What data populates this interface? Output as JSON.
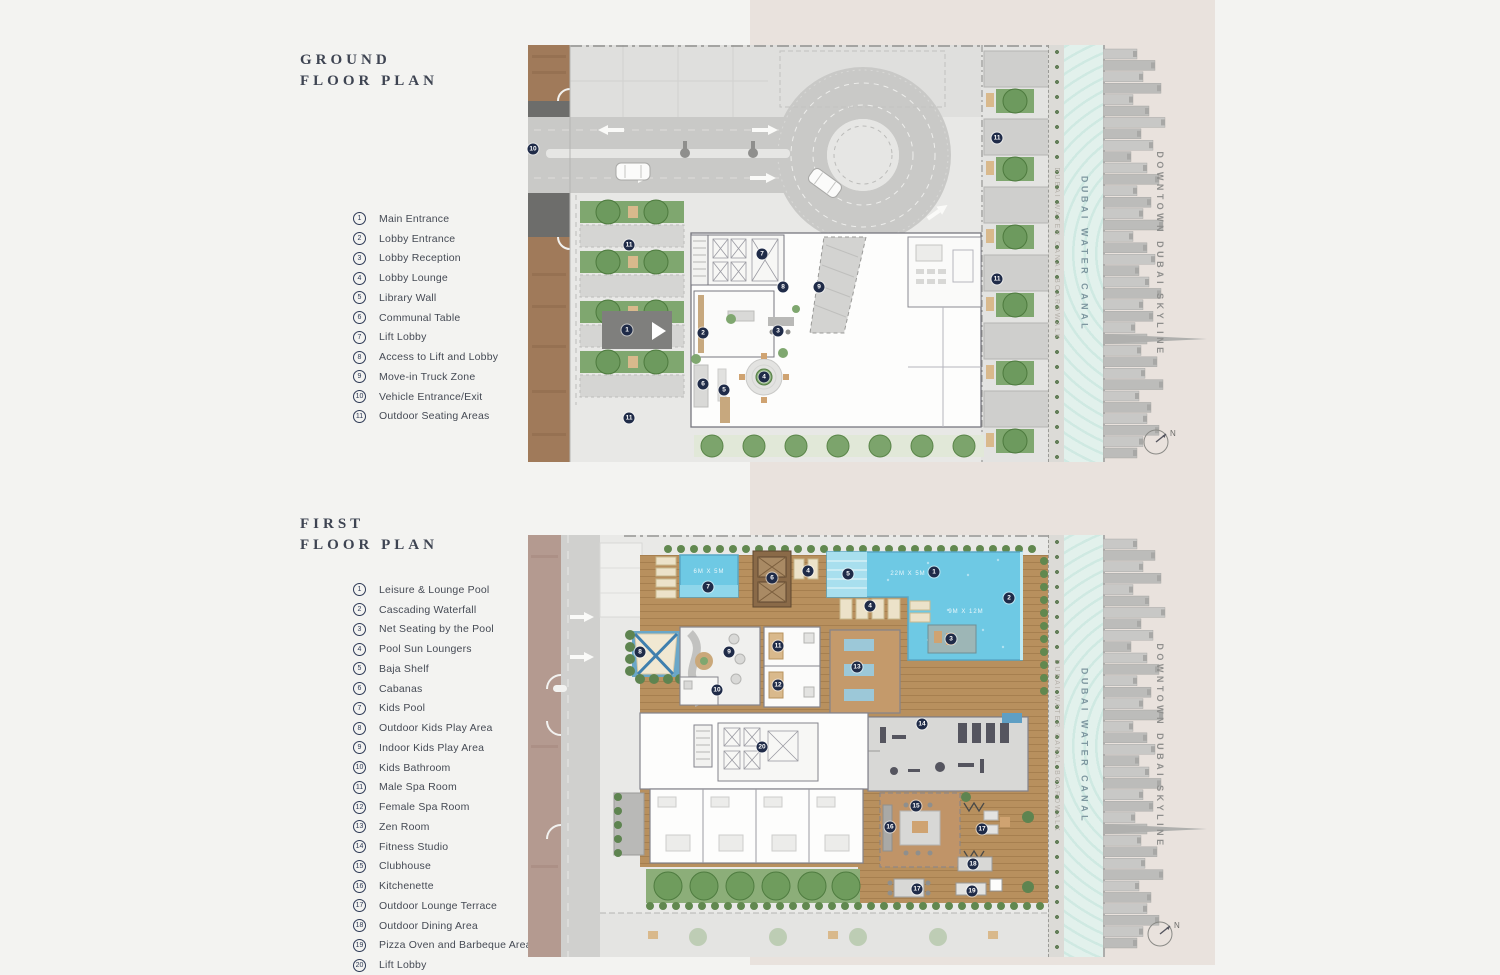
{
  "ground_section": {
    "title": "GROUND\nFLOOR PLAN",
    "legend": [
      {
        "n": "1",
        "label": "Main Entrance"
      },
      {
        "n": "2",
        "label": "Lobby Entrance"
      },
      {
        "n": "3",
        "label": "Lobby Reception"
      },
      {
        "n": "4",
        "label": "Lobby Lounge"
      },
      {
        "n": "5",
        "label": "Library Wall"
      },
      {
        "n": "6",
        "label": "Communal Table"
      },
      {
        "n": "7",
        "label": "Lift Lobby"
      },
      {
        "n": "8",
        "label": "Access to Lift and Lobby"
      },
      {
        "n": "9",
        "label": "Move-in Truck Zone"
      },
      {
        "n": "10",
        "label": "Vehicle Entrance/Exit"
      },
      {
        "n": "11",
        "label": "Outdoor Seating Areas"
      }
    ],
    "markers": [
      {
        "n": "1",
        "x": 99,
        "y": 285
      },
      {
        "n": "2",
        "x": 175,
        "y": 288
      },
      {
        "n": "3",
        "x": 250,
        "y": 286
      },
      {
        "n": "4",
        "x": 236,
        "y": 332
      },
      {
        "n": "5",
        "x": 196,
        "y": 345
      },
      {
        "n": "6",
        "x": 175,
        "y": 339
      },
      {
        "n": "7",
        "x": 234,
        "y": 209
      },
      {
        "n": "8",
        "x": 255,
        "y": 242
      },
      {
        "n": "9",
        "x": 291,
        "y": 242
      },
      {
        "n": "10",
        "x": 5,
        "y": 104
      },
      {
        "n": "11",
        "x": 101,
        "y": 200
      },
      {
        "n": "11",
        "x": 101,
        "y": 373
      },
      {
        "n": "11",
        "x": 469,
        "y": 93
      },
      {
        "n": "11",
        "x": 469,
        "y": 234
      }
    ]
  },
  "first_section": {
    "title": "FIRST\nFLOOR PLAN",
    "legend": [
      {
        "n": "1",
        "label": "Leisure & Lounge Pool"
      },
      {
        "n": "2",
        "label": "Cascading Waterfall"
      },
      {
        "n": "3",
        "label": "Net Seating by the Pool"
      },
      {
        "n": "4",
        "label": "Pool Sun Loungers"
      },
      {
        "n": "5",
        "label": "Baja Shelf"
      },
      {
        "n": "6",
        "label": "Cabanas"
      },
      {
        "n": "7",
        "label": "Kids Pool"
      },
      {
        "n": "8",
        "label": "Outdoor Kids Play Area"
      },
      {
        "n": "9",
        "label": "Indoor Kids Play Area"
      },
      {
        "n": "10",
        "label": "Kids Bathroom"
      },
      {
        "n": "11",
        "label": "Male Spa Room"
      },
      {
        "n": "12",
        "label": "Female Spa Room"
      },
      {
        "n": "13",
        "label": "Zen Room"
      },
      {
        "n": "14",
        "label": "Fitness Studio"
      },
      {
        "n": "15",
        "label": "Clubhouse"
      },
      {
        "n": "16",
        "label": "Kitchenette"
      },
      {
        "n": "17",
        "label": "Outdoor Lounge Terrace"
      },
      {
        "n": "18",
        "label": "Outdoor Dining Area"
      },
      {
        "n": "19",
        "label": "Pizza Oven and Barbeque Area"
      },
      {
        "n": "20",
        "label": "Lift Lobby"
      }
    ],
    "markers": [
      {
        "n": "7",
        "x": 180,
        "y": 52
      },
      {
        "n": "6",
        "x": 244,
        "y": 43
      },
      {
        "n": "4",
        "x": 280,
        "y": 36
      },
      {
        "n": "5",
        "x": 320,
        "y": 39
      },
      {
        "n": "1",
        "x": 406,
        "y": 37
      },
      {
        "n": "2",
        "x": 481,
        "y": 63
      },
      {
        "n": "4",
        "x": 342,
        "y": 71
      },
      {
        "n": "3",
        "x": 423,
        "y": 104
      },
      {
        "n": "8",
        "x": 112,
        "y": 117
      },
      {
        "n": "9",
        "x": 201,
        "y": 117
      },
      {
        "n": "11",
        "x": 250,
        "y": 111
      },
      {
        "n": "12",
        "x": 250,
        "y": 150
      },
      {
        "n": "13",
        "x": 329,
        "y": 132
      },
      {
        "n": "10",
        "x": 189,
        "y": 155
      },
      {
        "n": "14",
        "x": 394,
        "y": 189
      },
      {
        "n": "20",
        "x": 234,
        "y": 212
      },
      {
        "n": "15",
        "x": 388,
        "y": 271
      },
      {
        "n": "16",
        "x": 362,
        "y": 292
      },
      {
        "n": "17",
        "x": 454,
        "y": 294
      },
      {
        "n": "18",
        "x": 445,
        "y": 329
      },
      {
        "n": "17",
        "x": 389,
        "y": 354
      },
      {
        "n": "19",
        "x": 444,
        "y": 356
      }
    ],
    "pool_labels": {
      "kids": "6M X 5M",
      "main": "22M X 5M",
      "deep": "9M X 12M"
    }
  },
  "side": {
    "boardwalk_label": "DUBAI WATER CANAL BOARDWALK",
    "canal_label": "DUBAI WATER CANAL",
    "skyline_label": "DOWNTOWN DUBAI SKYLINE",
    "compass_north": "N"
  },
  "colors": {
    "page_bg": "#f3f3f1",
    "panel_pink": "#e9e2dd",
    "marker_navy": "#1f2b48",
    "pool_blue": "#6ec9e4",
    "deck_wood": "#b8905e",
    "landscape_green": "#6f9c5d",
    "canal_teal": "#dff0ec",
    "street_brown": "#a07a5a"
  }
}
